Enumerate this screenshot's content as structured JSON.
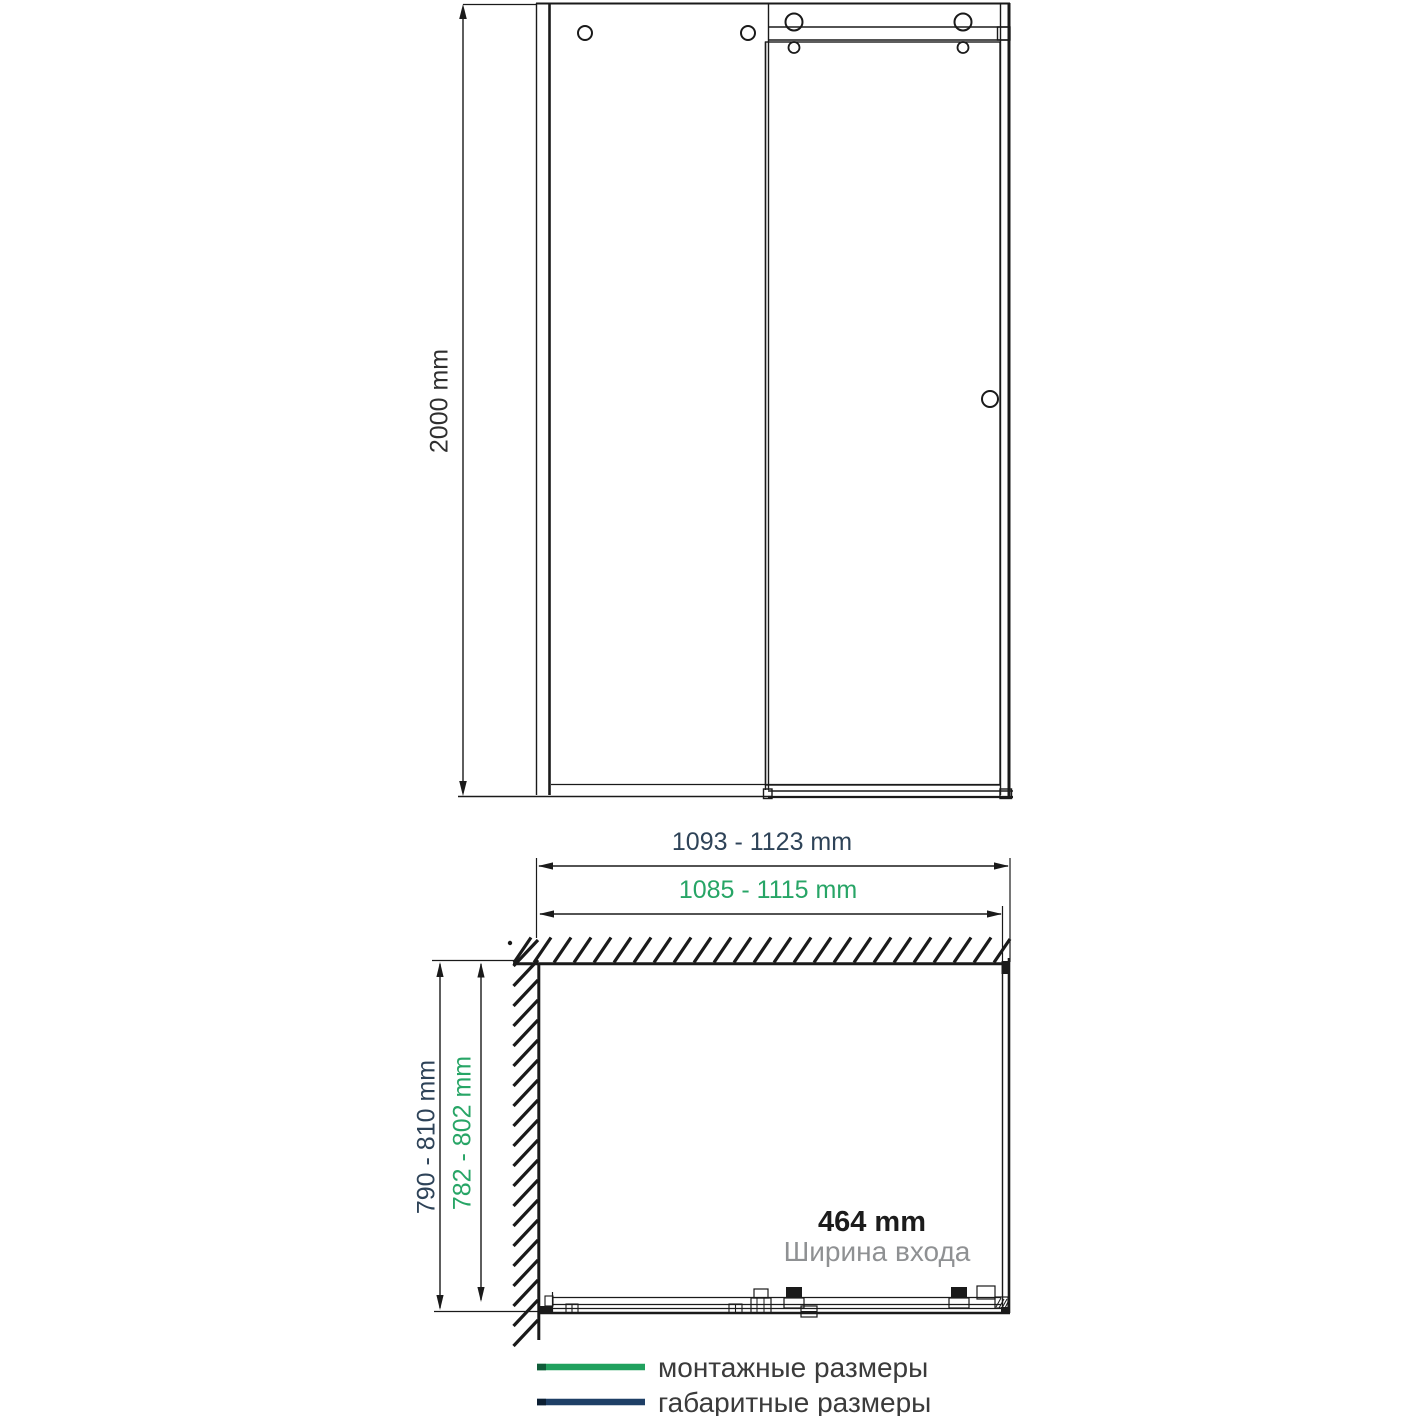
{
  "front_view": {
    "height_label": "2000 mm"
  },
  "plan_view": {
    "overall_width_label": "1093 - 1123 mm",
    "mounting_width_label": "1085 - 1115 mm",
    "overall_depth_label": "790 - 810 mm",
    "mounting_depth_label": "782 - 802 mm",
    "entry_width_label": "464 mm",
    "entry_width_caption": "Ширина входа"
  },
  "legend": {
    "items": [
      {
        "label": "монтажные размеры",
        "color": "#21a15e"
      },
      {
        "label": "габаритные размеры",
        "color": "#1e3f66"
      }
    ]
  },
  "colors": {
    "mounting_green": "#21a15e",
    "overall_navy": "#1e3f66",
    "text_green": "#27a566",
    "text_navy": "#2e4358",
    "drawing_line": "#1a1a1a",
    "muted_text": "#8f9193"
  }
}
